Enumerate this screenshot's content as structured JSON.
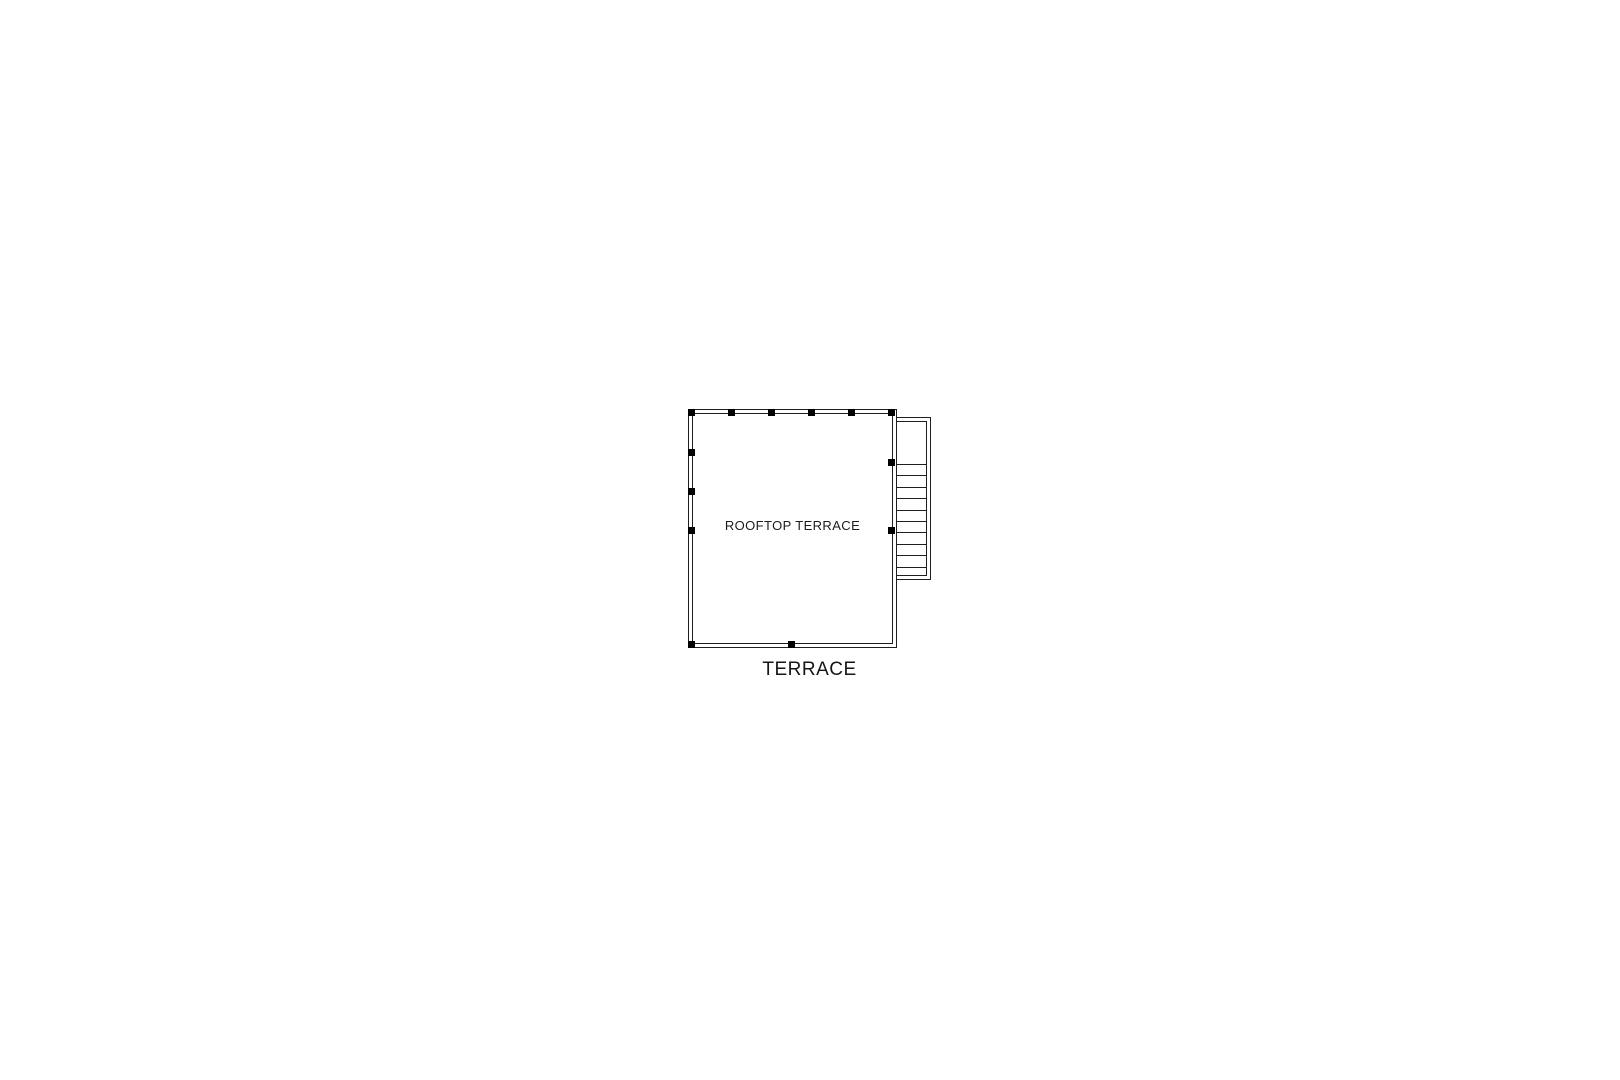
{
  "page": {
    "background_color": "#ffffff",
    "line_color": "#1f1f1f",
    "post_color": "#000000"
  },
  "plan": {
    "room_label": "ROOFTOP TERRACE",
    "floor_label": "TERRACE",
    "railing_posts": [
      [
        0,
        0
      ],
      [
        40,
        0
      ],
      [
        80,
        0
      ],
      [
        120,
        0
      ],
      [
        160,
        0
      ],
      [
        200,
        0
      ],
      [
        0,
        40
      ],
      [
        0,
        79
      ],
      [
        0,
        118
      ],
      [
        0,
        232
      ],
      [
        100,
        232
      ],
      [
        200,
        50
      ],
      [
        200,
        118
      ]
    ],
    "stairs": {
      "tread_count": 10,
      "first_tread_offset": 46,
      "tread_spacing": 11.4
    }
  }
}
